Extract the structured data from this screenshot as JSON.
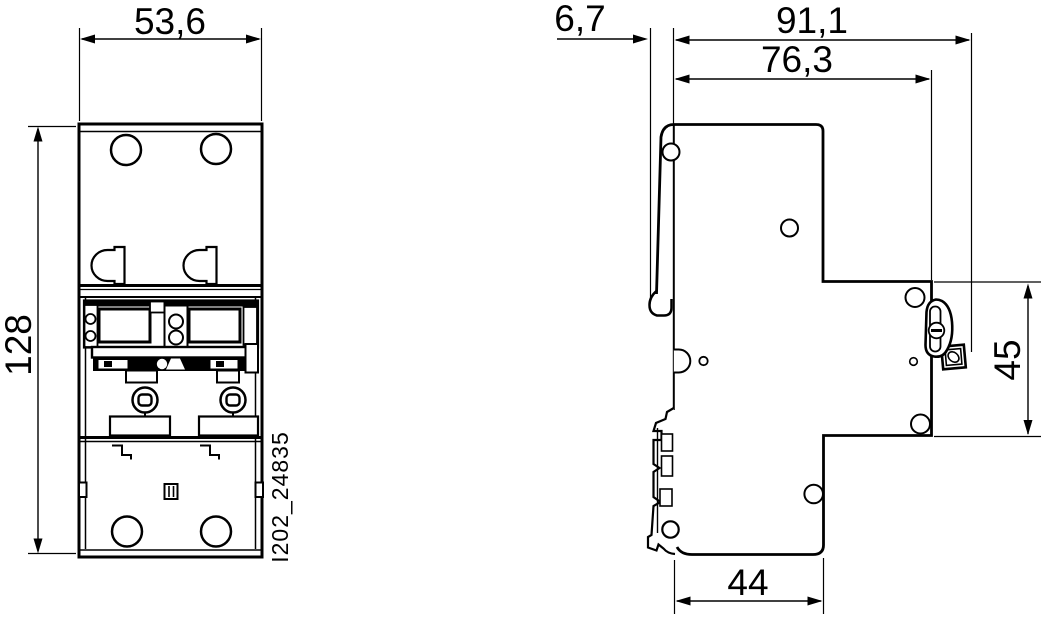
{
  "drawing": {
    "title": "technical dimension drawing, 2-pole modular device (front and side view)",
    "colors": {
      "background": "#ffffff",
      "line": "#000000"
    },
    "annotation": {
      "part_number": "I202_24835"
    },
    "front_view": {
      "dimensions": {
        "width_mm": "53,6",
        "height_mm": "128"
      }
    },
    "side_view": {
      "dimensions": {
        "handle_protrusion_mm": "6,7",
        "overall_depth_mm": "91,1",
        "housing_depth_mm": "76,3",
        "din_recess_height_mm": "45",
        "base_depth_mm": "44"
      }
    }
  }
}
